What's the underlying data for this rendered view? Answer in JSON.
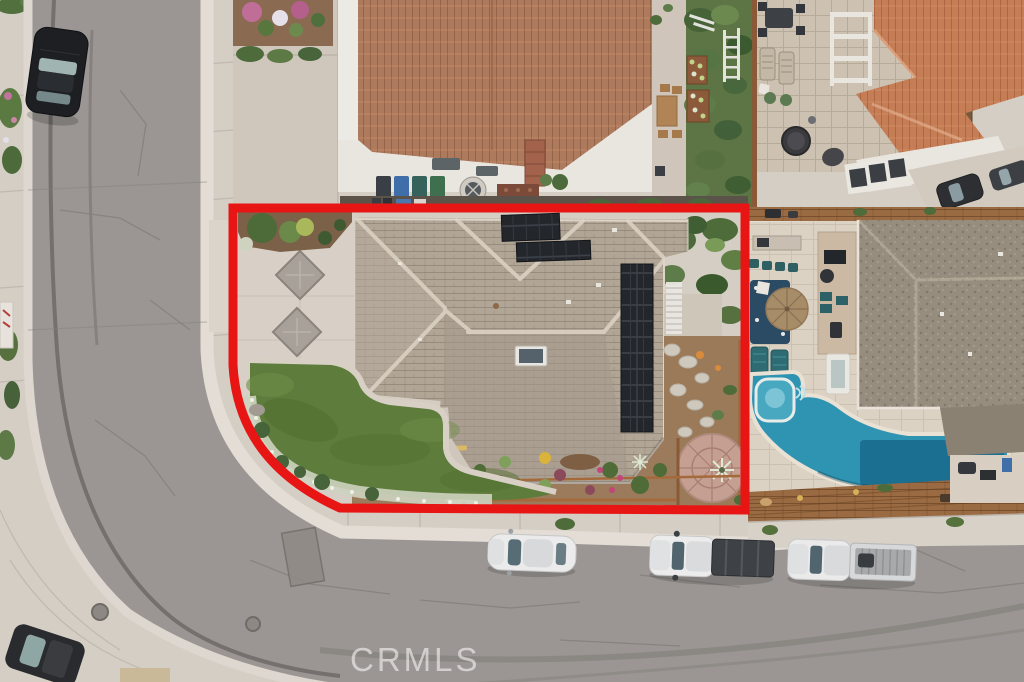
{
  "watermark": {
    "text": "CRMLS"
  },
  "scene": {
    "type": "aerial-drone-photo-of-corner-lot-home",
    "property_boundary": "red-outline",
    "parked_vehicle_street_left": "black-sedan",
    "parked_vehicles_street_bottom": [
      "white-sedan",
      "white-pickup-tonneau-cover",
      "white-pickup-open-bed"
    ],
    "features": [
      "gray-tile-hip-roof",
      "rooftop-solar-panels",
      "driveway-diamond-inlays",
      "front-lawn",
      "white-flower-border",
      "flagstone-path",
      "round-flagstone-patio",
      "neighbor-swimming-pool",
      "spa",
      "patio-umbrella",
      "wood-deck",
      "outdoor-furniture",
      "fire-pit",
      "trash-bins",
      "terracotta-roof-neighbors",
      "curved-street"
    ]
  },
  "colors": {
    "concrete": "#d5cec5",
    "road_asphalt": "#9b9693",
    "boundary_red": "#e81515",
    "roof_main": "#b1a596",
    "roof_top_house": "#ae7a5d",
    "roof_right_top": "#c47d55",
    "roof_right_house": "#978d7e",
    "solar_panel": "#23262b",
    "lawn_green": "#5e7c3b",
    "pool_water": "#2f93b2",
    "pool_deep": "#17688a",
    "wood_deck": "#9a6a42",
    "umbrella_tan": "#a78c68",
    "travertine": "#dcd2c4",
    "patio_paver": "#cdc1b1"
  }
}
